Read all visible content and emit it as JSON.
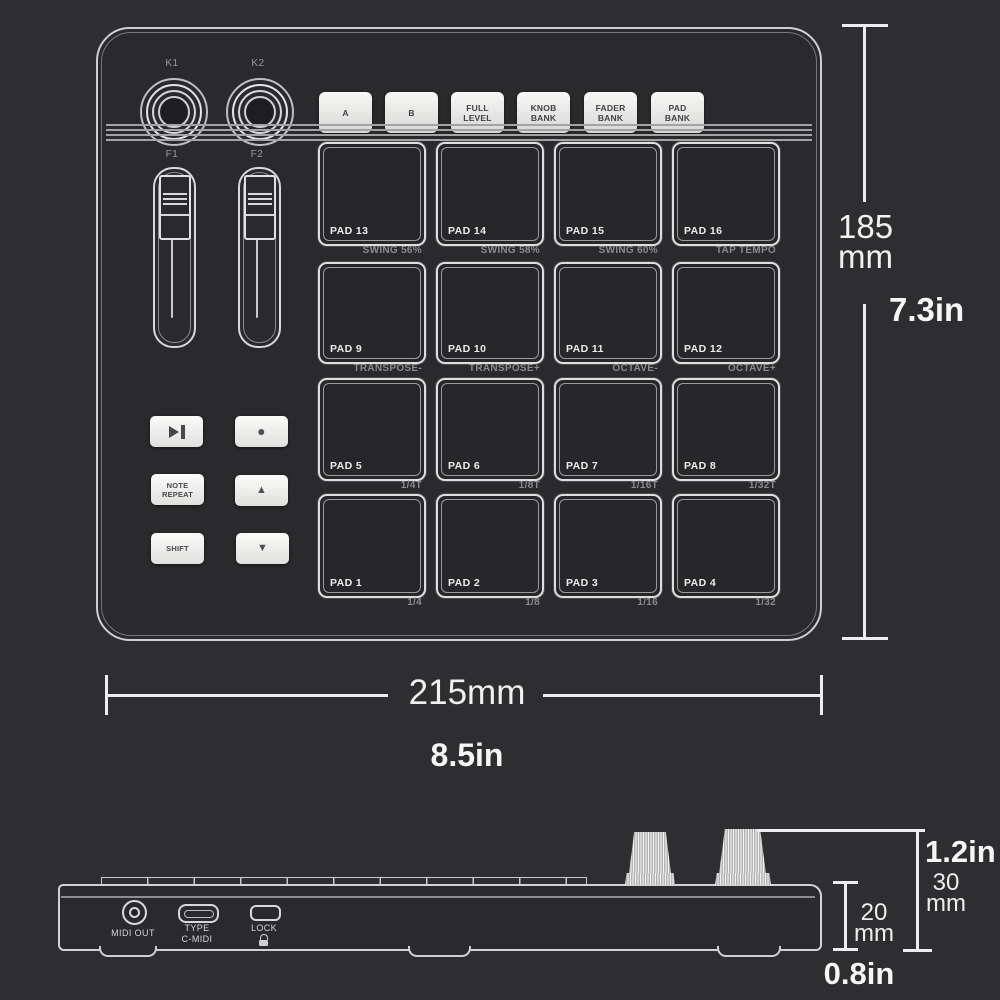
{
  "top_view": {
    "knobs": [
      {
        "label": "K1"
      },
      {
        "label": "K2"
      }
    ],
    "buttons": [
      {
        "label": "A"
      },
      {
        "label": "B"
      },
      {
        "label": "FULL\nLEVEL"
      },
      {
        "label": "KNOB\nBANK"
      },
      {
        "label": "FADER\nBANK"
      },
      {
        "label": "PAD\nBANK"
      }
    ],
    "faders": [
      {
        "label": "F1"
      },
      {
        "label": "F2"
      }
    ],
    "transport": {
      "record_icon": "●",
      "note_repeat_label": "NOTE\nREPEAT",
      "up_icon": "▲",
      "shift_label": "SHIFT",
      "down_icon": "▼"
    },
    "pad_rows": [
      {
        "pads": [
          {
            "name": "PAD 13",
            "sub": "SWING 56%"
          },
          {
            "name": "PAD 14",
            "sub": "SWING 58%"
          },
          {
            "name": "PAD 15",
            "sub": "SWING 60%"
          },
          {
            "name": "PAD 16",
            "sub": "TAP TEMPO"
          }
        ]
      },
      {
        "pads": [
          {
            "name": "PAD 9",
            "sub": "TRANSPOSE-"
          },
          {
            "name": "PAD 10",
            "sub": "TRANSPOSE+"
          },
          {
            "name": "PAD 11",
            "sub": "OCTAVE-"
          },
          {
            "name": "PAD 12",
            "sub": "OCTAVE+"
          }
        ]
      },
      {
        "pads": [
          {
            "name": "PAD 5",
            "sub": "1/4T"
          },
          {
            "name": "PAD 6",
            "sub": "1/8T"
          },
          {
            "name": "PAD 7",
            "sub": "1/16T"
          },
          {
            "name": "PAD 8",
            "sub": "1/32T"
          }
        ]
      },
      {
        "pads": [
          {
            "name": "PAD 1",
            "sub": "1/4"
          },
          {
            "name": "PAD 2",
            "sub": "1/8"
          },
          {
            "name": "PAD 3",
            "sub": "1/16"
          },
          {
            "name": "PAD 4",
            "sub": "1/32"
          }
        ]
      }
    ]
  },
  "dimensions": {
    "height_metric": "185\nmm",
    "height_imperial": "7.3in",
    "width_metric": "215mm",
    "width_imperial": "8.5in",
    "knob_height_imperial": "1.2in",
    "knob_height_metric": "30\nmm",
    "body_height_metric": "20\nmm",
    "body_height_imperial": "0.8in"
  },
  "side_view": {
    "midi_out_label": "MIDI OUT",
    "usb_label": "TYPE\nC-MIDI",
    "lock_label": "LOCK"
  },
  "colors": {
    "background": "#2e2e30",
    "device_face": "#2a2a2c",
    "outline": "#d2d2d4",
    "pad_fill": "#27272a",
    "button_face": "#efefed",
    "button_text": "#434345",
    "sub_label": "#8b8b8e",
    "dimension_text": "#f1f1f2"
  }
}
